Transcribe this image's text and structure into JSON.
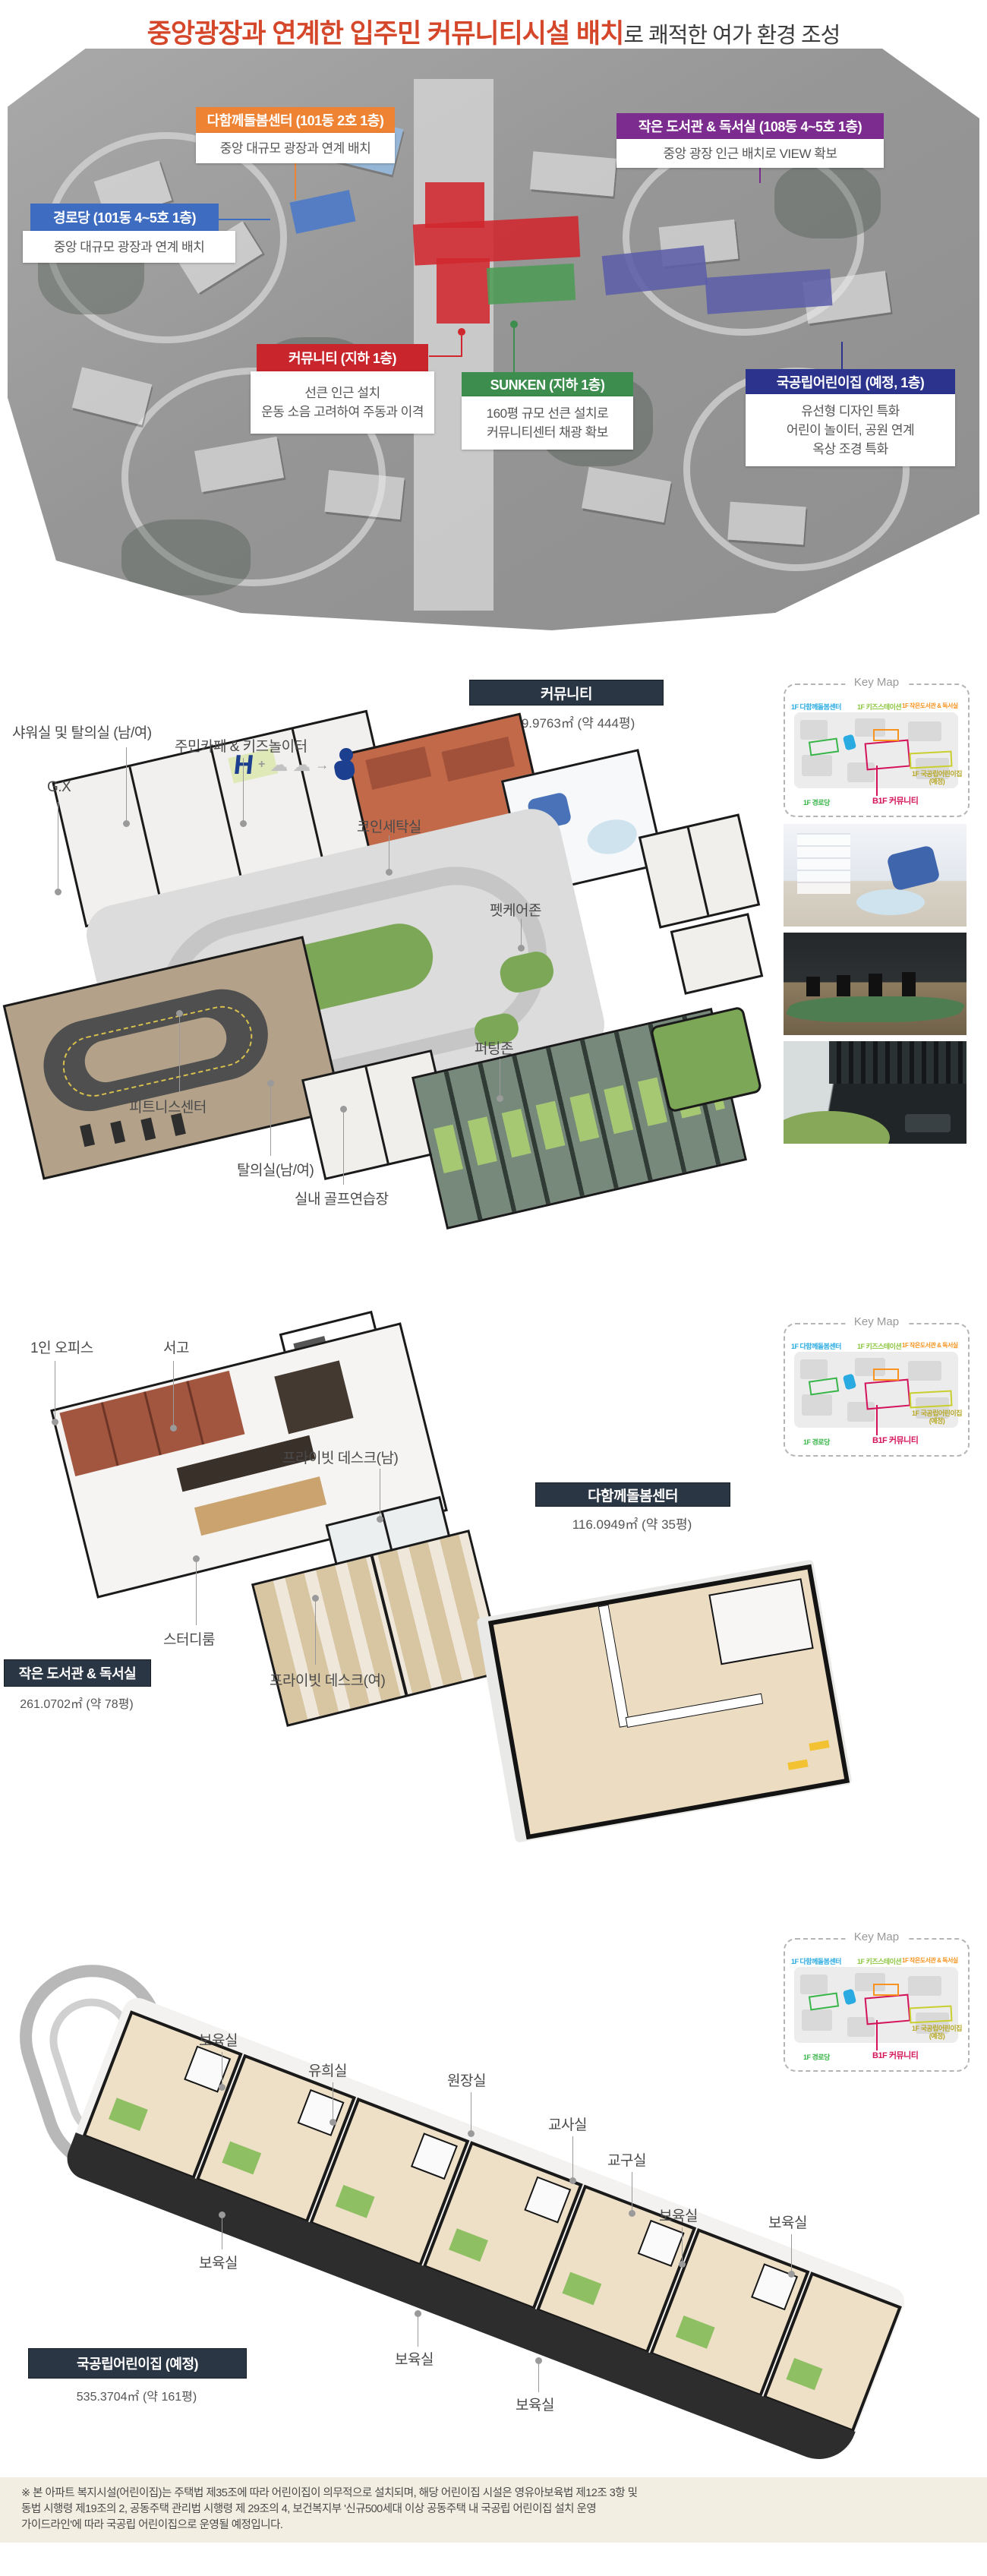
{
  "header": {
    "title_highlight": "중앙광장과 연계한 입주민 커뮤니티시설 배치",
    "title_rest": "로 쾌적한 여가 환경 조성",
    "highlight_color": "#d5472a"
  },
  "siteplan": {
    "callouts": [
      {
        "title": "다함께돌봄센터 (101동 2호 1층)",
        "desc": [
          "중앙 대규모 광장과 연계 배치"
        ],
        "color": "#ee8334"
      },
      {
        "title": "작은 도서관 & 독서실 (108동 4~5호 1층)",
        "desc": [
          "중앙 광장 인근 배치로 VIEW 확보"
        ],
        "color": "#7c2c8e"
      },
      {
        "title": "경로당 (101동 4~5호 1층)",
        "desc": [
          "중앙 대규모 광장과 연계 배치"
        ],
        "color": "#3e6cc0"
      },
      {
        "title": "커뮤니티 (지하 1층)",
        "desc": [
          "선큰 인근 설치",
          "운동 소음 고려하여 주동과 이격"
        ],
        "color": "#c9252c"
      },
      {
        "title": "SUNKEN (지하 1층)",
        "desc": [
          "160평 규모 선큰 설치로",
          "커뮤니티센터 채광 확보"
        ],
        "color": "#3c8d4e"
      },
      {
        "title": "국공립어린이집 (예정, 1층)",
        "desc": [
          "유선형 디자인 특화",
          "어린이 놀이터, 공원 연계",
          "옥상 조경 특화"
        ],
        "color": "#2b338c"
      }
    ]
  },
  "keymap": {
    "title": "Key Map",
    "labels": [
      {
        "text": "1F 다함께돌봄센터",
        "color": "#29abe2"
      },
      {
        "text": "1F 키즈스테이션",
        "color": "#8cc63f"
      },
      {
        "text": "1F 작은도서관 & 독서실",
        "color": "#f7931e"
      },
      {
        "text": "1F 국공립어린이집 (예정)",
        "color": "#b8a927"
      },
      {
        "text": "1F 경로당",
        "color": "#39b54a"
      },
      {
        "text": "B1F 커뮤니티",
        "color": "#d4145a"
      }
    ]
  },
  "community": {
    "name": "커뮤니티",
    "area": "1,469.9763㎡ (약 444평)",
    "labels": [
      "샤워실 및 탈의실 (남/여)",
      "주민카페 & 키즈놀이터",
      "G.X",
      "코인세탁실",
      "펫케어존",
      "퍼팅존",
      "피트니스센터",
      "탈의실(남/여)",
      "실내 골프연습장"
    ],
    "mascot": {
      "letter": "H",
      "plus": "+",
      "arrow": "→"
    }
  },
  "library": {
    "name": "작은 도서관 & 독서실",
    "area": "261.0702㎡ (약 78평)",
    "labels": [
      "1인 오피스",
      "서고",
      "프라이빗 데스크(남)",
      "스터디룸",
      "프라이빗 데스크(여)"
    ]
  },
  "care_center": {
    "name": "다함께돌봄센터",
    "area": "116.0949㎡ (약 35평)"
  },
  "daycare": {
    "name": "국공립어린이집 (예정)",
    "area": "535.3704㎡ (약 161평)",
    "labels": [
      "보육실",
      "유희실",
      "원장실",
      "교사실",
      "교구실",
      "보육실",
      "보육실",
      "보육실",
      "보육실",
      "보육실"
    ]
  },
  "footnote": {
    "lines": [
      "※ 본 아파트 복지시설(어린이집)는 주택법 제35조에 따라 어린이집이 의무적으로 설치되며, 해당 어린이집 시설은 영유아보육법 제12조 3항 및",
      "동법 시행령 제19조의 2, 공동주택 관리법 시행령 제 29조의 4, 보건복지부 '신규500세대 이상 공동주택 내 국공립 어린이집 설치 운영",
      "가이드라인'에 따라 국공립 어린이집으로 운영될 예정입니다."
    ]
  }
}
